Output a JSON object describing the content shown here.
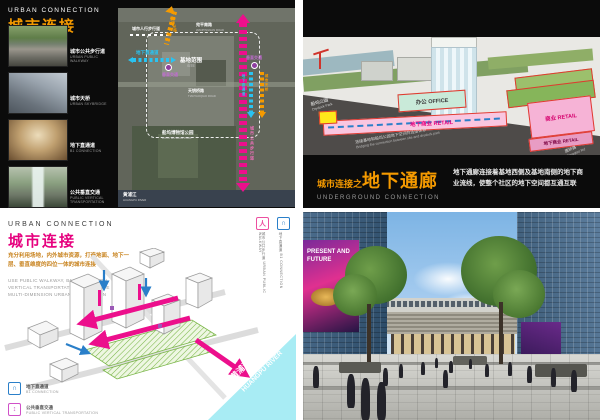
{
  "colors": {
    "orange": "#f59a00",
    "magenta": "#ec0f8c",
    "cyan": "#29c3f2",
    "blue": "#2a7fc9",
    "purple": "#a050c8",
    "pink_fill": "#f9c6e0",
    "mint_fill": "#c9ead9",
    "river_cyan": "#a8ecf4"
  },
  "top_left": {
    "title_en": "URBAN CONNECTION",
    "title_zh": "城市连接",
    "photos": [
      {
        "zh": "城市公共步行道",
        "en": "URBAN PUBLIC WALKWAY"
      },
      {
        "zh": "城市天桥",
        "en": "URBAN SKYBRIDGE"
      },
      {
        "zh": "地下直通道",
        "en": "B1 CONNECTION"
      },
      {
        "zh": "公共垂直交通",
        "en": "PUBLIC VERTICAL TRANSPORTATION"
      }
    ],
    "map": {
      "walkway_label": "城市人行步行道",
      "b1_label": "地下直通道",
      "vt_label_left": "垂直交通",
      "vt_label_right": "垂直交通",
      "skybridge_label": "城市天桥",
      "skybridge_label_right": "城市天桥",
      "riverwalk_label": "城市公共步行道",
      "b1_label_right": "地下直通道",
      "site_zh": "基地范围",
      "site_en": "SITE",
      "road_top_zh": "宛平南路",
      "road_top_en": "WANPINGNAN ROAD",
      "road_mid_zh": "天钥桥路",
      "road_mid_en": "TIANYAOQIAO ROAD",
      "park_zh": "船坞博物馆公园",
      "park_en": "DOCK MUSEUM PARK",
      "river_zh": "黄浦江",
      "river_en": "HUANGPU RIVER"
    }
  },
  "top_right": {
    "axon": {
      "office": "办公 OFFICE",
      "retail_corridor": "地下商业 RETAIL",
      "retail_box": "商业 RETAIL",
      "retail_b1": "地下商业 RETAIL",
      "park_zh": "船坞公园",
      "park_en": "Drydock Park",
      "note_zh": "连接基地和船坞公园地下空间的连接体系",
      "note_en": "Bridging the connection between site and drydock park",
      "road_zh": "唐桥路",
      "road_en": "Tangqiao Rd"
    },
    "title_prefix": "城市连接之",
    "title_main": "地下通廊",
    "subtitle": "UNDERGROUND CONNECTION",
    "description": "地下通廊连接着基地西侧及基地南侧的地下商业流线，使整个社区的地下空间都互通互联"
  },
  "bottom_left": {
    "title_en": "URBAN CONNECTION",
    "title_zh": "城市连接",
    "desc_zh": "充分利用场地，内外城市资源，打造地面、地下一层、垂直维度的四位一体的城市连接",
    "desc_en": "USE PUBLIC WALKWAY, B1 CONNECTION, VERTICAL TRANSPORTATION, TO CREATE MULTI-DIMENSION URBAN CONNECTION",
    "side_icons": [
      {
        "zh": "城市公共步行道",
        "en": "URBAN PUBLIC WALKWAY"
      },
      {
        "zh": "地下直通道",
        "en": "B1 CONNECTION"
      }
    ],
    "legend": [
      {
        "zh": "地下直通道",
        "en": "B1 CONNECTION"
      },
      {
        "zh": "公共垂直交通",
        "en": "PUBLIC VERTICAL TRANSPORTATION"
      }
    ],
    "river_zh": "黄浦江",
    "river_en": "HUANGPU RIVER"
  },
  "bottom_right": {
    "billboard": "PRESENT AND FUTURE"
  }
}
